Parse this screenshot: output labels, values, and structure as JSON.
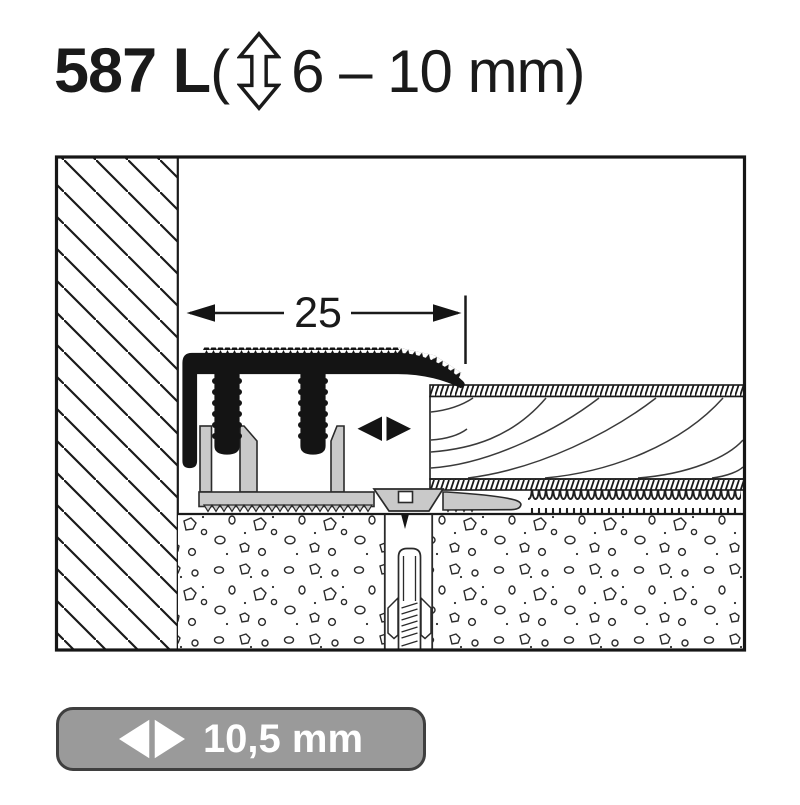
{
  "title": {
    "model": "587 L",
    "open_paren": "(",
    "height_arrow_icon": "up-down-arrow-outline",
    "height_range": "6 – 10 mm",
    "close_paren": ")"
  },
  "diagram": {
    "dimension_label": "25",
    "adjust_arrows_icon": "left-right-arrows",
    "elements": {
      "wall": "hatched-wall",
      "top_profile": "black-adaptation-profile",
      "base_profile": "gray-base-channel",
      "screw": "countersunk-screw",
      "dowel": "wall-plug-in-screed",
      "flooring": "wood-flooring-plank",
      "underlay": "resilient-underlay",
      "screed": "stippled-screed"
    },
    "colors": {
      "line": "#1a1a1a",
      "profile_black": "#141414",
      "base_gray": "#c9c9c9",
      "badge_gray": "#9a9a9a"
    }
  },
  "badge": {
    "arrow_icon": "left-right-arrows",
    "width_label": "10,5 mm"
  }
}
